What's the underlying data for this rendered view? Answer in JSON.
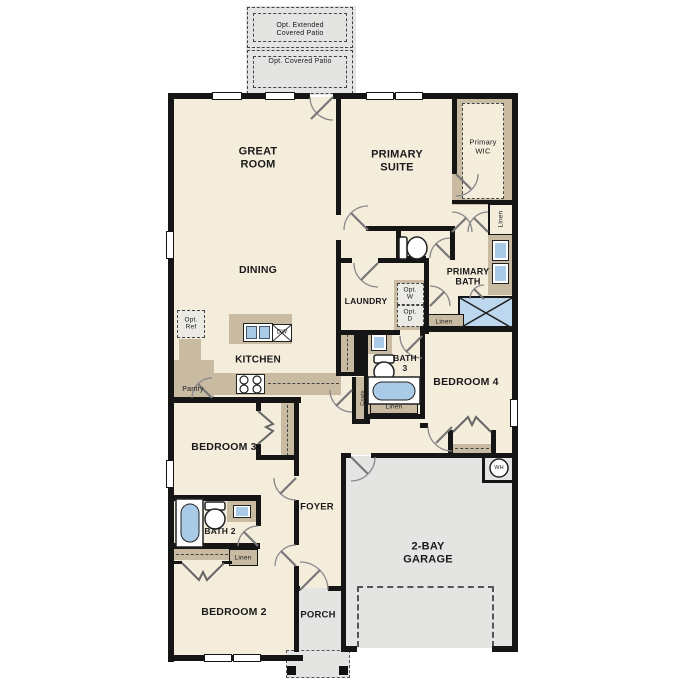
{
  "plan": {
    "rooms": {
      "great_room": "GREAT\nROOM",
      "primary_suite": "PRIMARY\nSUITE",
      "dining": "DINING",
      "kitchen": "KITCHEN",
      "laundry": "LAUNDRY",
      "primary_bath": "PRIMARY\nBATH",
      "primary_wic": "Primary\nWIC",
      "bath_3": "BATH\n3",
      "bedroom_4": "BEDROOM 4",
      "bedroom_3": "BEDROOM 3",
      "foyer": "FOYER",
      "bath_2": "BATH 2",
      "bedroom_2": "BEDROOM 2",
      "porch": "PORCH",
      "garage": "2-BAY\nGARAGE"
    },
    "options": {
      "extended_patio": "Opt. Extended\nCovered Patio",
      "covered_patio": "Opt. Covered Patio",
      "ref": "Opt.\nRef",
      "washer": "Opt.\nW",
      "dryer": "Opt.\nD"
    },
    "closets": {
      "linen_wic": "Linen",
      "linen_primary_bath": "Linen",
      "linen_bath3": "Linen",
      "linen_bath2": "Linen",
      "pantry": "Pantry",
      "coats": "Coats"
    },
    "appliances": {
      "dishwasher": "DW",
      "water_heater": "WH"
    },
    "colors": {
      "wall": "#151515",
      "floor": "#f4eddc",
      "cabinet": "#c8bba1",
      "concrete": "#e4e4e2",
      "fixture_blue": "#aacbe7",
      "door_stroke": "#888888"
    }
  }
}
